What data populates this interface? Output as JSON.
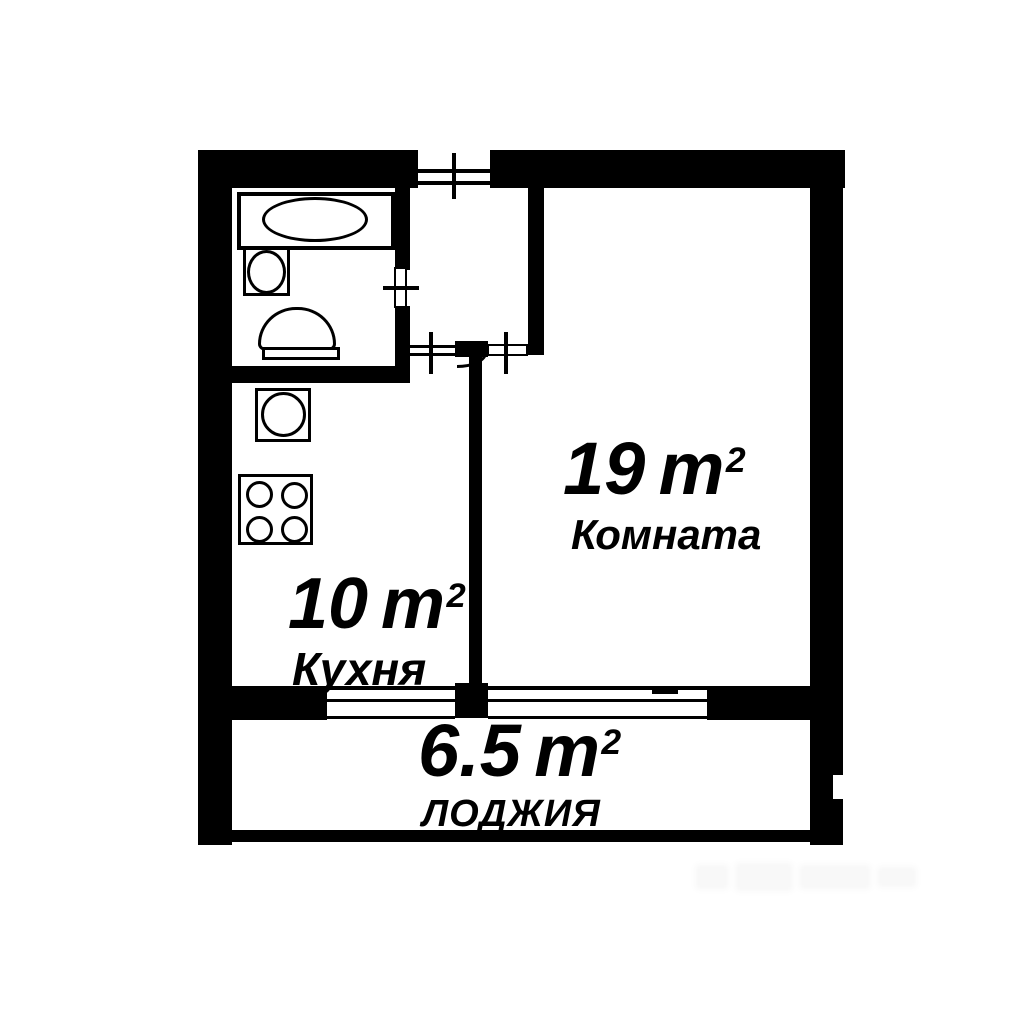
{
  "plan_title": "apartment-floor-plan",
  "rooms": {
    "living": {
      "area": "19",
      "unit": "m",
      "sup": "2",
      "name": "Комната"
    },
    "kitchen": {
      "area": "10",
      "unit": "m",
      "sup": "2",
      "name": "Кухня"
    },
    "loggia": {
      "area": "6.5",
      "unit": "m",
      "sup": "2",
      "name": "ЛОДЖИЯ"
    }
  },
  "fixtures": [
    "bathtub-icon",
    "washbasin-icon",
    "toilet-icon",
    "kitchen-sink-icon",
    "stove-icon"
  ],
  "colors": {
    "wall": "#000000",
    "bg": "#ffffff"
  }
}
